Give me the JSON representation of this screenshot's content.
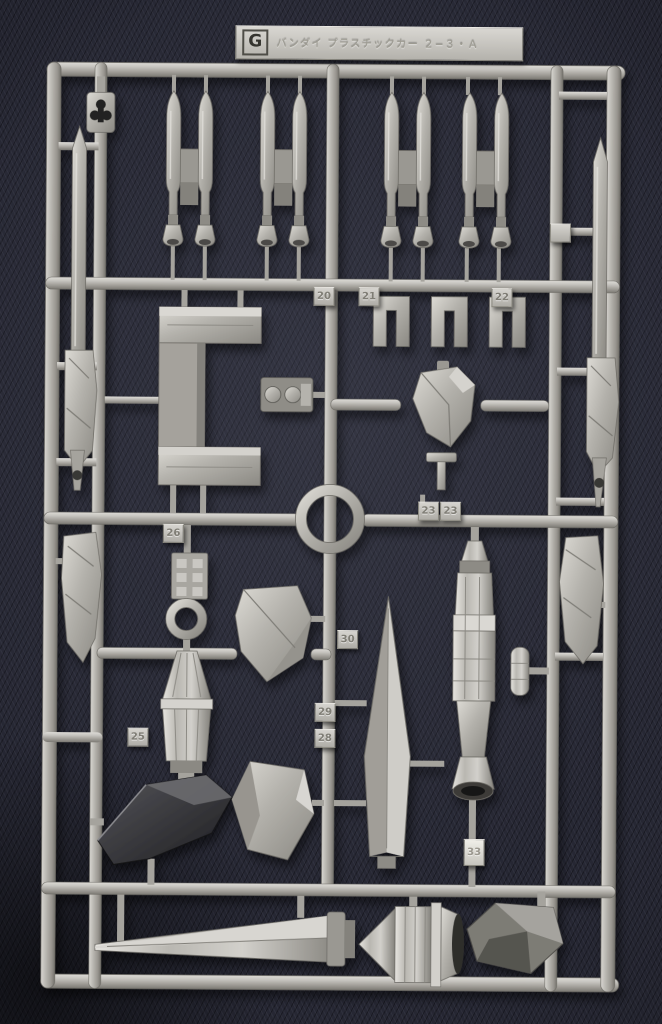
{
  "scene": {
    "subject": "plastic-model-kit-runner-sprue-photo",
    "runner_letter": "G",
    "runner_tag_text": "バンダイ プラスチックカー ２−３・Ａ",
    "gate_labels": [
      "20",
      "21",
      "22",
      "23",
      "23",
      "26",
      "30",
      "29",
      "28",
      "25",
      "33",
      ""
    ],
    "palette": {
      "plastic": "#b6b3ad",
      "plastic_highlight": "#dddbd6",
      "plastic_shadow": "#7b7973",
      "dark_part": "#2e2e33",
      "fabric_background": "#24252e"
    },
    "parts": [
      "twin-missile-pod x4",
      "long-beam-blade x2",
      "c-bracket",
      "machinery-greeble",
      "sight-ring",
      "u-clip x3",
      "claw-part",
      "t-handle",
      "segmented-booster",
      "side-cylinder",
      "dagger-blade",
      "armor-plate x2",
      "thruster-cone",
      "dark-wing-blade",
      "peg-block",
      "washer-ring",
      "long-sword",
      "nozzle-cluster",
      "corner-bracket",
      "hanger-clip"
    ]
  }
}
